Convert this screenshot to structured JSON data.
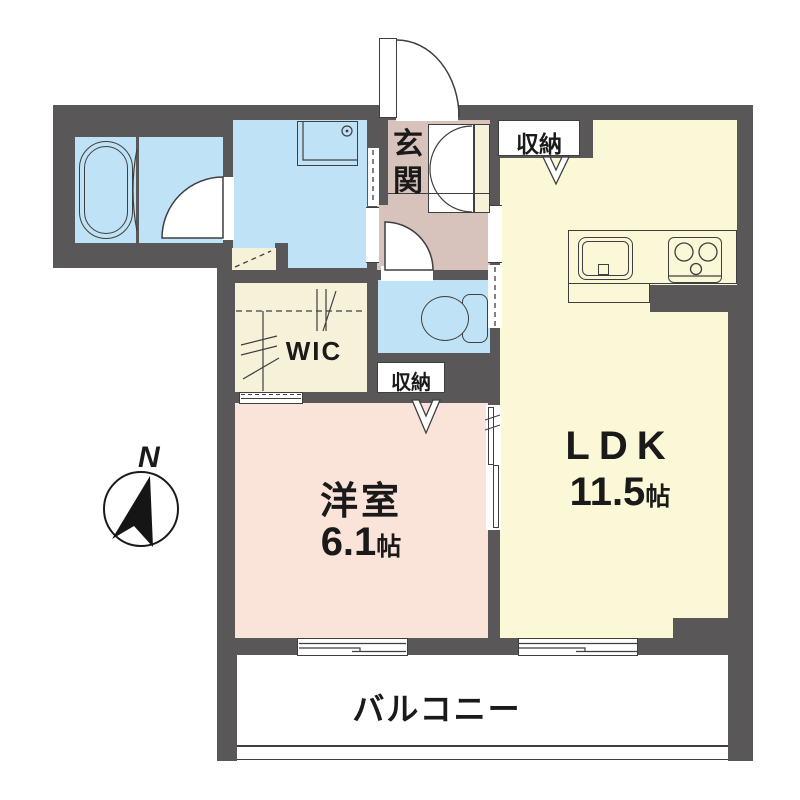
{
  "plan_type": "apartment-floor-plan",
  "compass": {
    "north_label": "N"
  },
  "rooms": {
    "entrance": {
      "label": "玄関"
    },
    "storage_ldk": {
      "label": "収納"
    },
    "storage_bedroom": {
      "label": "収納"
    },
    "wic": {
      "label": "WIC"
    },
    "bedroom": {
      "label": "洋室",
      "area_value": "6.1",
      "area_unit": "帖"
    },
    "ldk": {
      "label": "LDK",
      "area_value": "11.5",
      "area_unit": "帖"
    },
    "balcony": {
      "label": "バルコニー"
    }
  },
  "colors": {
    "wall": "#595757",
    "water_rooms_blue": "#bfe2f6",
    "entrance_mauve": "#d8c3bc",
    "ldk_yellow": "#faf8d6",
    "bedroom_pink": "#fae3d8",
    "closet_cream": "#f6f2da",
    "line": "#3f3f3f",
    "text": "#1a1a1a"
  }
}
